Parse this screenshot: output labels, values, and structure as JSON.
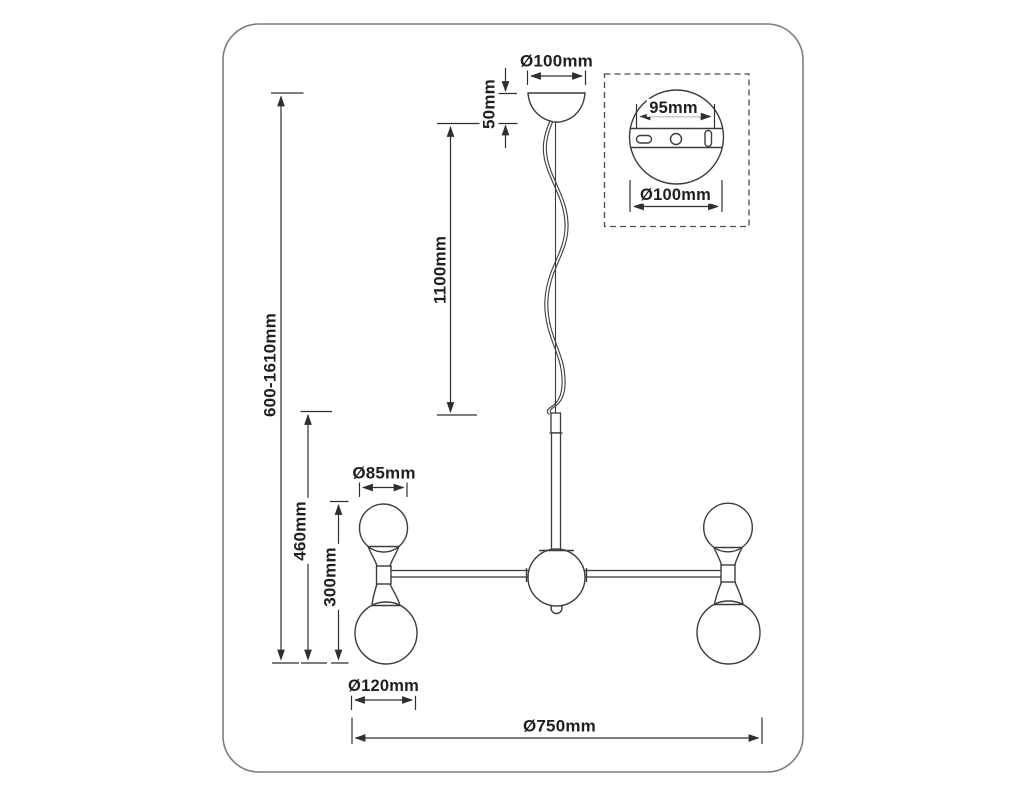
{
  "page": {
    "background": "#ffffff",
    "line_color": "#3c3c3c",
    "dimension_line_color": "#2f2f2f",
    "frame_color": "#7d7d7d",
    "text_color": "#1f1f1f"
  },
  "diagram": {
    "type": "technical-dimension-drawing",
    "subject": "pendant chandelier with 4 double-globe arms",
    "dimensions": {
      "canopy_diameter": "Ø100mm",
      "canopy_height": "50mm",
      "cable_length": "1100mm",
      "overall_height": "600-1610mm",
      "body_height": "460mm",
      "arm_unit_height": "300mm",
      "small_globe_diameter": "Ø85mm",
      "large_globe_diameter": "Ø120mm",
      "overall_diameter": "Ø750mm"
    },
    "detail_inset": {
      "plate_width": "95mm",
      "canopy_diameter": "Ø100mm"
    }
  }
}
